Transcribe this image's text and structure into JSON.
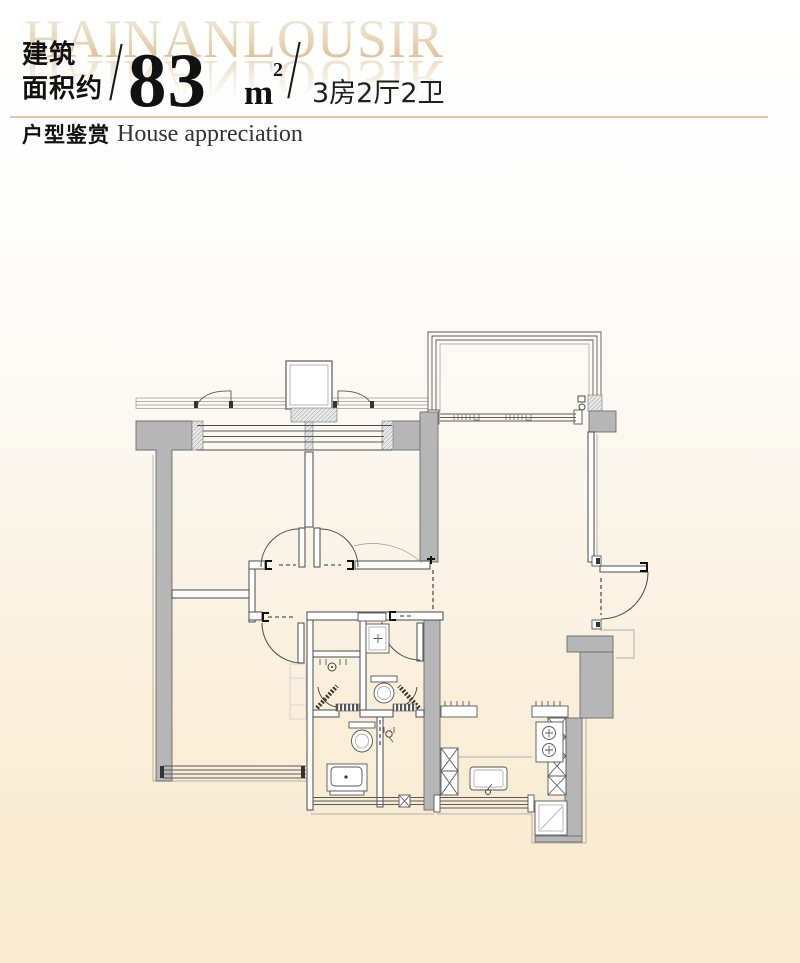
{
  "watermark": "HAINANLOUSIR",
  "header": {
    "area_label_line1": "建筑",
    "area_label_line2": "面积约",
    "slash_left": "/",
    "area_value": "83",
    "area_unit": "m",
    "area_unit_exponent": "2",
    "slash_right": "/",
    "layout_spec": "3房2厅2卫"
  },
  "section": {
    "title_cn": "户型鉴赏",
    "title_en": "House appreciation"
  },
  "floor_plan": {
    "kind": "apartment floor plan drawing",
    "features": "2 bedrooms + master suite, hallway double doors, 2 bathrooms with toilets and shower doors, kitchen with sink and 2-burner stove, balcony with sliding door, entrance door"
  },
  "colors": {
    "divider_tan": "#dcc8a7",
    "watermark_tan": "#e0ba8c",
    "wall_gray": "#b6b6b6",
    "background_bottom": "#f9ecd2",
    "text_primary": "#111111"
  }
}
